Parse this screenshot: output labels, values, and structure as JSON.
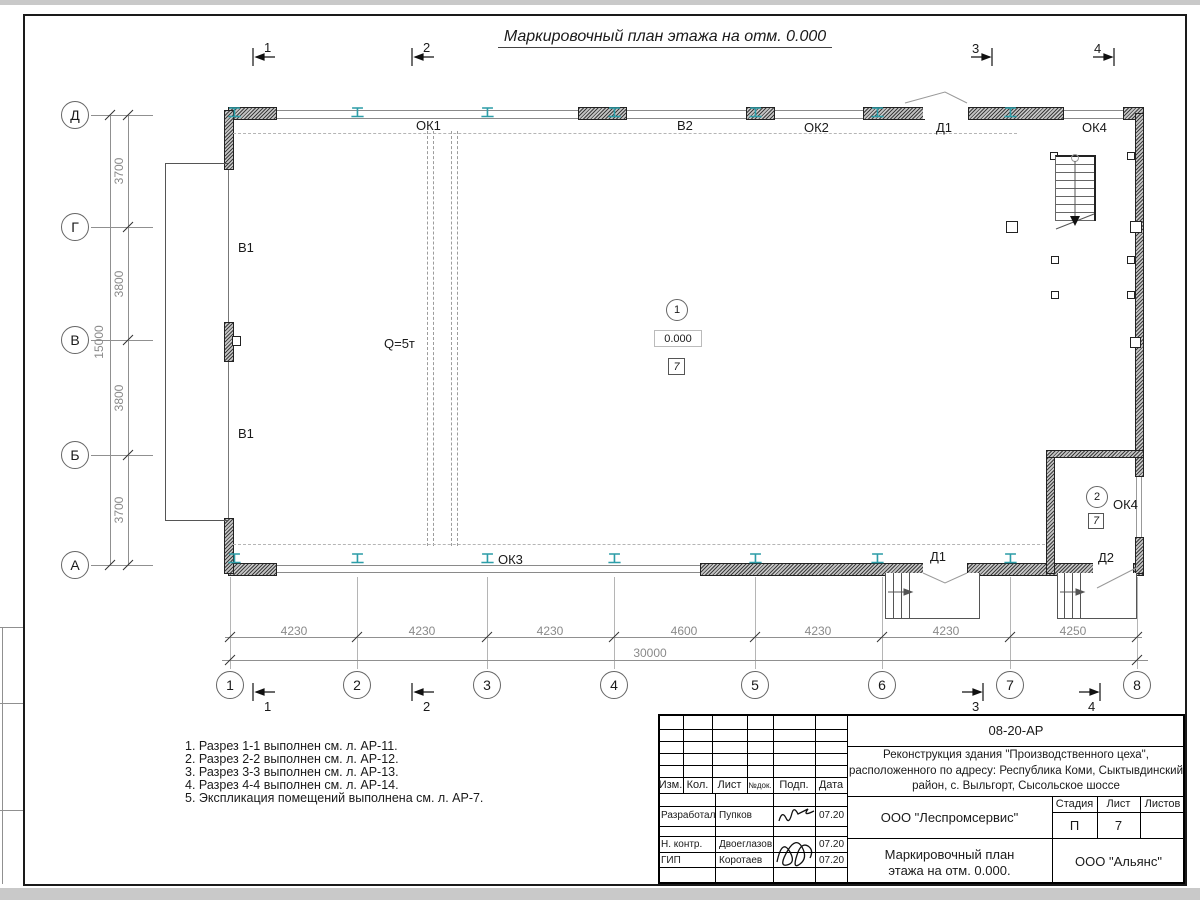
{
  "title": "Маркировочный план этажа на отм. 0.000",
  "plan": {
    "axis_letters": [
      "Д",
      "Г",
      "В",
      "Б",
      "А"
    ],
    "axis_numbers": [
      "1",
      "2",
      "3",
      "4",
      "5",
      "6",
      "7",
      "8"
    ],
    "v_dims": [
      "3700",
      "3800",
      "3800",
      "3700"
    ],
    "v_total": "15000",
    "h_dims": [
      "4230",
      "4230",
      "4230",
      "4600",
      "4230",
      "4230",
      "4250"
    ],
    "h_total": "30000",
    "sections": {
      "s1": "1",
      "s2": "2",
      "s3": "3",
      "s4": "4"
    },
    "labels": {
      "ok1": "ОК1",
      "v2": "В2",
      "ok2": "ОК2",
      "d1_top": "Д1",
      "ok4_top": "ОК4",
      "v1_upper": "В1",
      "v1_lower": "В1",
      "crane": "Q=5т",
      "ok3": "ОК3",
      "d1_bottom": "Д1",
      "d2": "Д2",
      "ok4_room": "ОК4"
    },
    "room1": {
      "num": "1",
      "elevation": "0.000",
      "type": "7"
    },
    "room2": {
      "num": "2",
      "type": "7"
    }
  },
  "notes": [
    "1. Разрез 1-1 выполнен см. л. АР-11.",
    "2. Разрез 2-2 выполнен см. л. АР-12.",
    "3. Разрез 3-3 выполнен см. л. АР-13.",
    "4. Разрез 4-4 выполнен см. л. АР-14.",
    "5. Экспликация помещений выполнена см. л. АР-7."
  ],
  "titleblock": {
    "code": "08-20-АР",
    "project_line1": "Реконструкция здания \"Производственного цеха\",",
    "project_line2": "расположенного по адресу: Республика Коми, Сыктывдинский",
    "project_line3": "район, с. Выльгорт, Сысольское шоссе",
    "col_headers": [
      "Изм.",
      "Кол.",
      "Лист",
      "№док.",
      "Подп.",
      "Дата"
    ],
    "signers": [
      {
        "role": "Разработал",
        "name": "Пупков",
        "date": "07.20"
      },
      {
        "role": "Н. контр.",
        "name": "Двоеглазов",
        "date": "07.20"
      },
      {
        "role": "ГИП",
        "name": "Коротаев",
        "date": "07.20"
      }
    ],
    "org": "ООО \"Леспромсервис\"",
    "stage_label": "Стадия",
    "sheet_label": "Лист",
    "sheets_label": "Листов",
    "stage": "П",
    "sheet_no": "7",
    "sheets_total": "",
    "doc_title_line1": "Маркировочный план",
    "doc_title_line2": "этажа на отм. 0.000.",
    "org2": "ООО \"Альянс\""
  },
  "colors": {
    "ibeam": "#2d9da8",
    "dim_text": "#8a8a8a"
  }
}
